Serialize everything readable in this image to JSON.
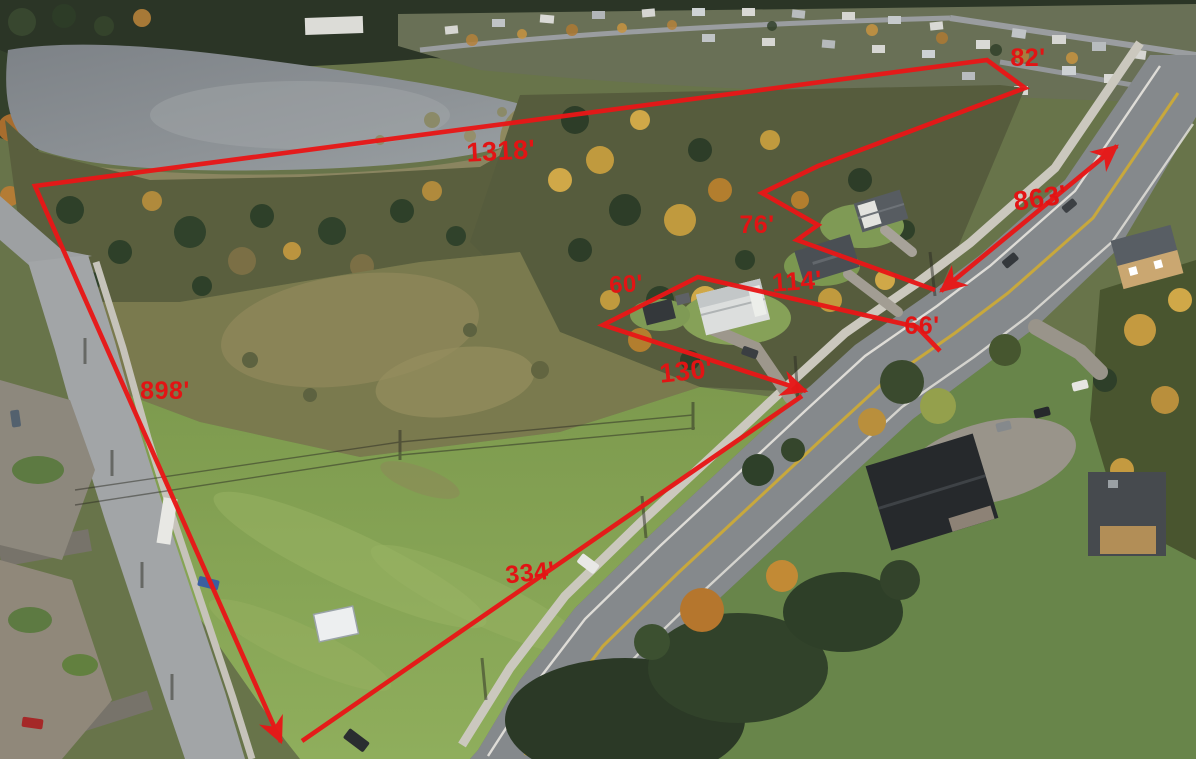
{
  "scene": {
    "kind": "aerial-drone-photo",
    "description": "Autumn aerial photo of a large vacant parcel beside a lake and highway, with red surveyed boundary overlay",
    "season_palette": {
      "lake": "#8b9095",
      "conifer": "#2d3d28",
      "autumn_leaf": "#c49a40",
      "grass": "#86a456",
      "asphalt": "#8a8e91"
    }
  },
  "overlay": {
    "line_color": "#e81717",
    "label_color": "#e21414",
    "labels": {
      "north_line": {
        "text": "1318'"
      },
      "northeast_jog": {
        "text": "82'"
      },
      "west_line": {
        "text": "898'"
      },
      "lot1_side": {
        "text": "76'"
      },
      "lot2_back": {
        "text": "114'"
      },
      "lot2_east": {
        "text": "66'"
      },
      "lot2_west": {
        "text": "60'"
      },
      "lot2_front": {
        "text": "130'"
      },
      "road_front": {
        "text": "334'"
      },
      "road_frontage": {
        "text": "863'"
      }
    }
  }
}
